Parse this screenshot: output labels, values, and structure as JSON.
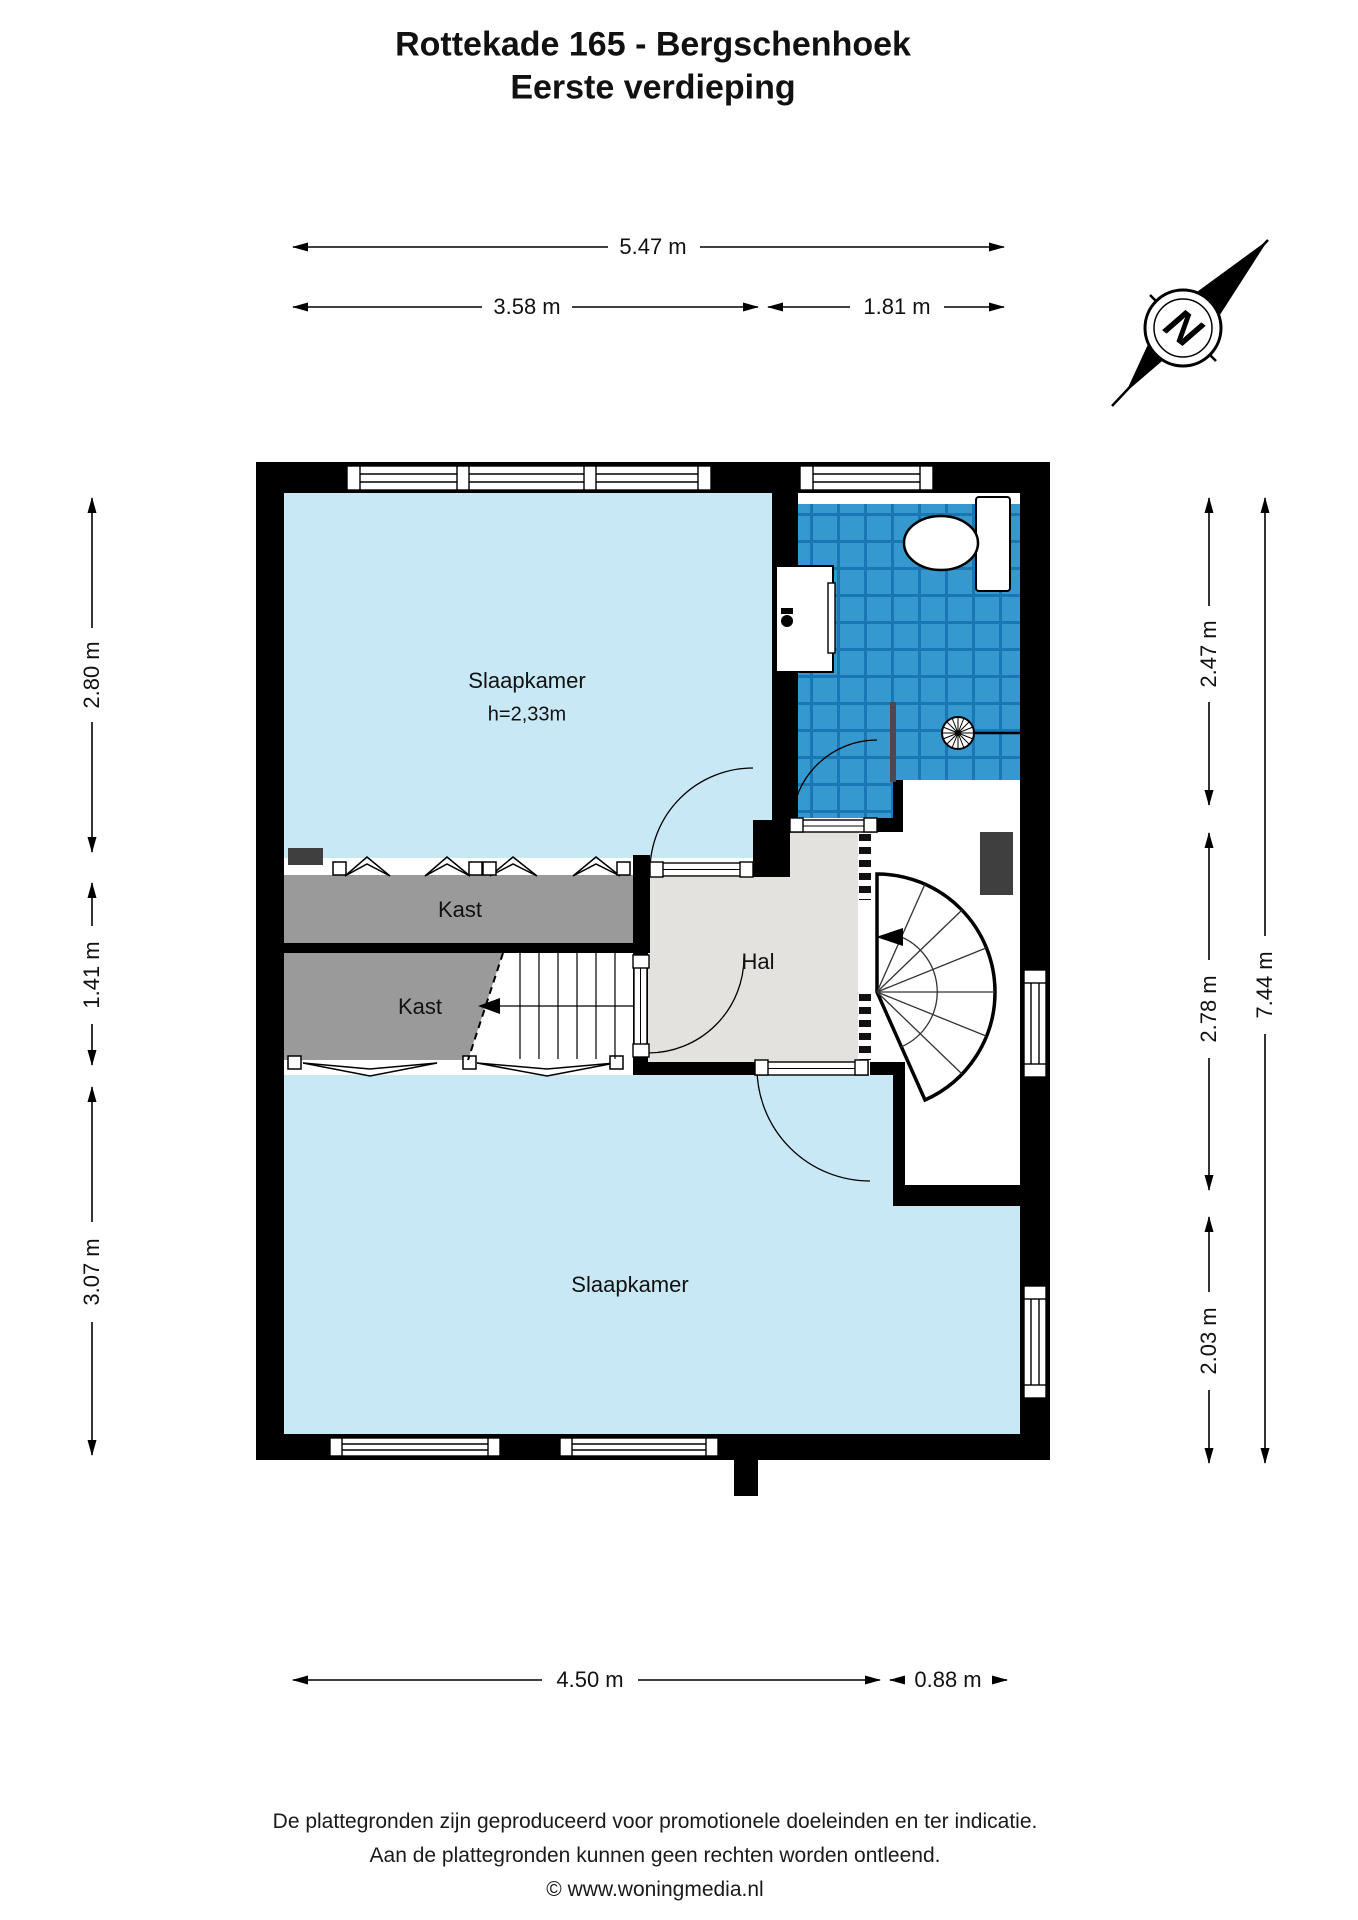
{
  "title": {
    "line1": "Rottekade 165 - Bergschenhoek",
    "line2": "Eerste verdieping"
  },
  "compass": {
    "label": "N"
  },
  "rooms": {
    "slaapkamer1": {
      "name": "Slaapkamer",
      "height_note": "h=2,33m"
    },
    "kast1": {
      "name": "Kast"
    },
    "kast2": {
      "name": "Kast"
    },
    "hal": {
      "name": "Hal"
    },
    "slaapkamer2": {
      "name": "Slaapkamer"
    }
  },
  "dimensions": {
    "top_total": "5.47 m",
    "top_left": "3.58 m",
    "top_right": "1.81 m",
    "left_upper": "2.80 m",
    "left_middle": "1.41 m",
    "left_lower": "3.07 m",
    "right_upper": "2.47 m",
    "right_middle": "2.78 m",
    "right_lower": "2.03 m",
    "right_total": "7.44 m",
    "bottom_left": "4.50 m",
    "bottom_right": "0.88 m"
  },
  "footer": {
    "line1": "De plattegronden zijn geproduceerd voor promotionele doeleinden en ter indicatie.",
    "line2": "Aan de plattegronden kunnen geen rechten worden ontleend.",
    "line3": "© www.woningmedia.nl"
  },
  "colors": {
    "wall-black": "#000000",
    "room-blue": "#C7E8F4",
    "tile-blue": "#3598CF",
    "tile-grout": "#1B77B4",
    "closet-gray": "#9A9A9A",
    "hall-gray": "#E3E2DE",
    "duct-gray": "#3F3F3F"
  }
}
